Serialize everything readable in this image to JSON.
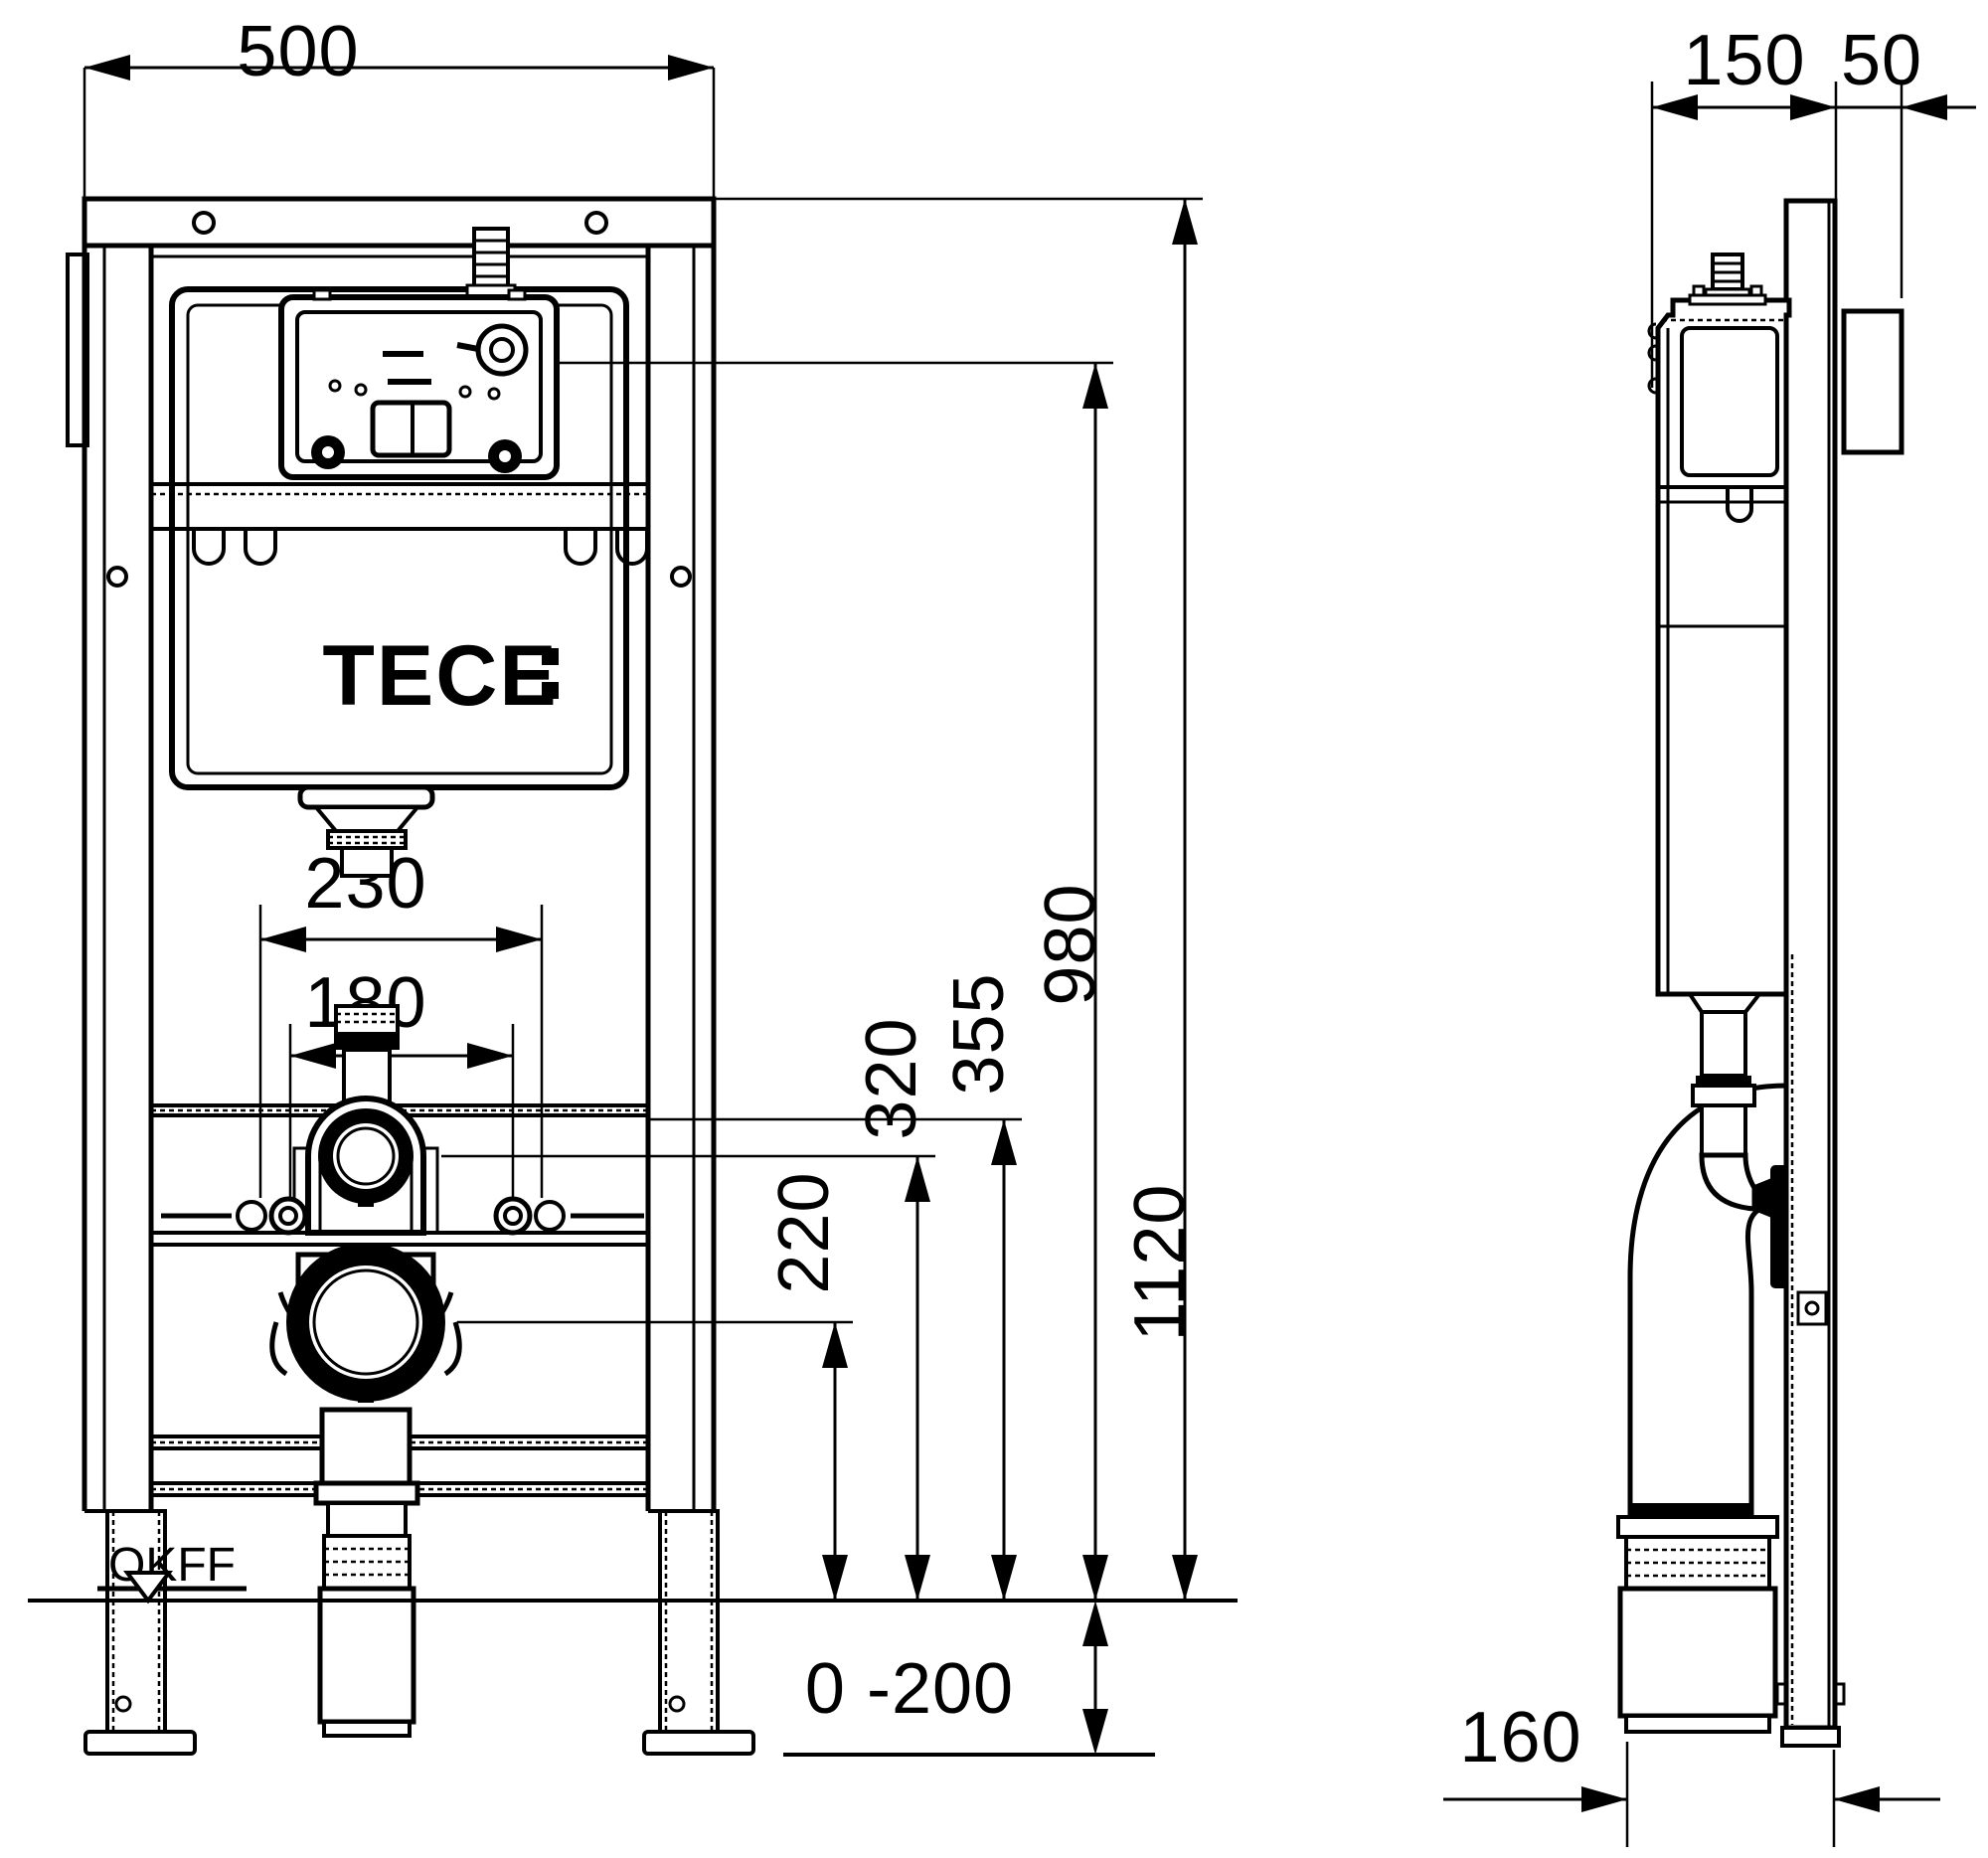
{
  "page": {
    "title": "WC installation frame dimensional drawing",
    "background_color": "#ffffff",
    "line_color": "#000000"
  },
  "logo": {
    "text": "TECE"
  },
  "front_view": {
    "dim_width": "500",
    "dim_height_overall": "1120",
    "dim_height_service": "980",
    "dim_bolt_outer": "230",
    "dim_bolt_inner": "180",
    "dim_flush_elbow": "320",
    "dim_rail": "355",
    "dim_drain": "220",
    "dim_leg_range": "0 -200",
    "floor_label": "OKFF"
  },
  "side_view": {
    "dim_depth_frame": "150",
    "dim_wall": "50",
    "dim_drain_offset": "160"
  }
}
